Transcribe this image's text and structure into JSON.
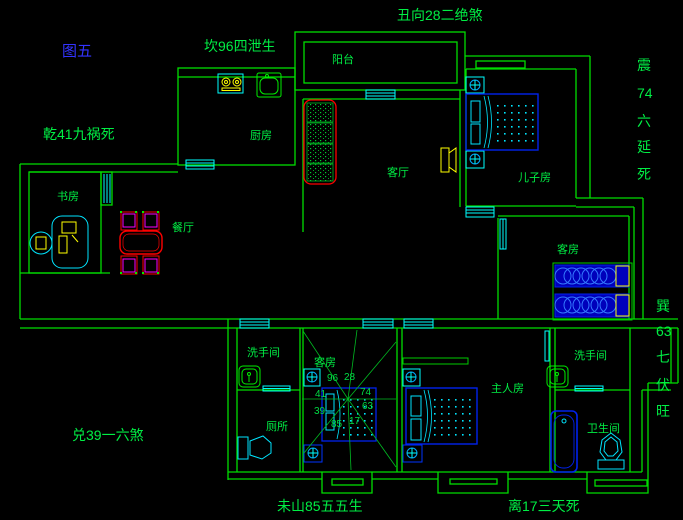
{
  "figure_title": "图五",
  "fengshui_labels": {
    "top_center": "丑向28二绝煞",
    "top_left": "坎96四泄生",
    "west_upper": "乾41九祸死",
    "west_lower": "兑39一六煞",
    "south_left": "未山85五五生",
    "south_right": "离17三天死",
    "east_upper": [
      "震",
      "74",
      "六",
      "延",
      "死"
    ],
    "east_lower": [
      "巽",
      "63",
      "七",
      "伏",
      "旺"
    ]
  },
  "rooms": {
    "balcony": {
      "label": "阳台"
    },
    "kitchen": {
      "label": "厨房"
    },
    "living_room": {
      "label": "客厅"
    },
    "sons_room": {
      "label": "儿子房"
    },
    "study": {
      "label": "书房"
    },
    "dining": {
      "label": "餐厅"
    },
    "guest_room_east": {
      "label": "客房"
    },
    "guest_room_center": {
      "label": "客房"
    },
    "master_room": {
      "label": "主人房"
    },
    "washroom_west": {
      "label": "洗手间"
    },
    "toilet_room": {
      "label": "厕所"
    },
    "washroom_east": {
      "label": "洗手间"
    },
    "bathroom": {
      "label": "卫生间"
    }
  },
  "compass": {
    "numbers": [
      "96",
      "28",
      "41",
      "74",
      "39",
      "63",
      "85",
      "17"
    ]
  },
  "colors": {
    "background": "#000000",
    "wall_green": "#00dd00",
    "fixture_cyan": "#00ffff",
    "furniture_blue": "#0022ee",
    "accent_red": "#ff0000",
    "accent_magenta": "#ff00ff",
    "accent_yellow": "#ffff00",
    "title_blue": "#3333ff"
  }
}
